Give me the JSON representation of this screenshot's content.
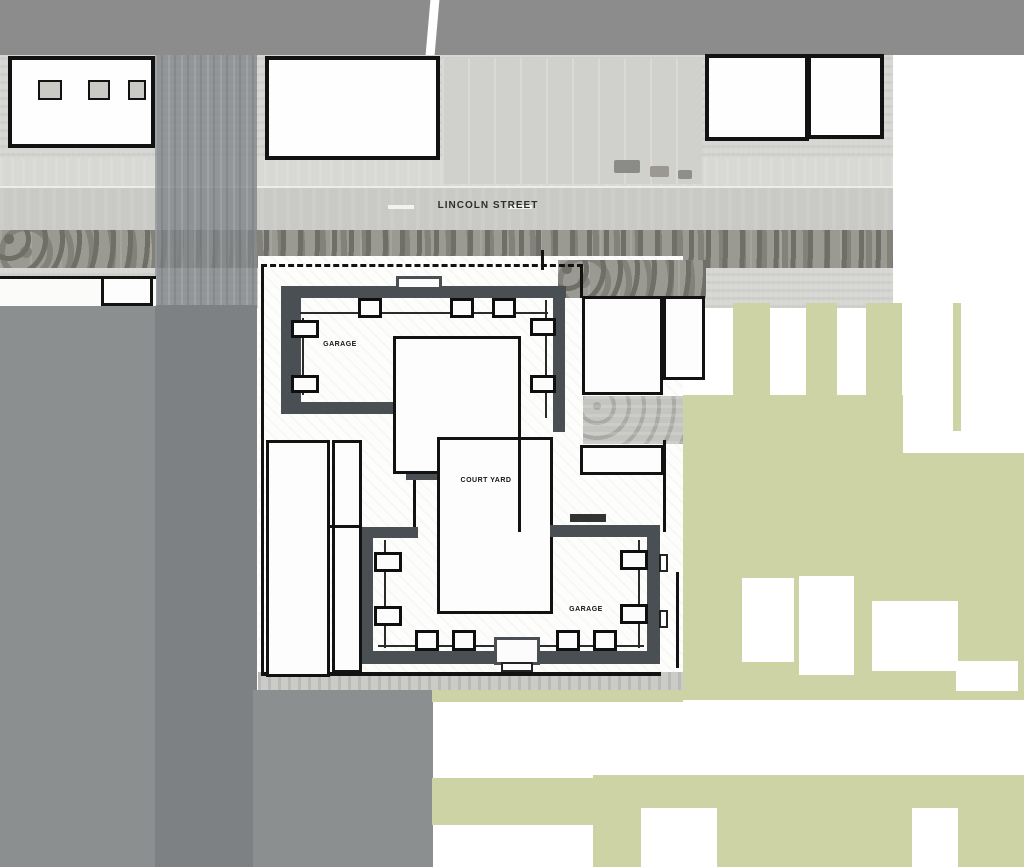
{
  "street": {
    "name_label": "LINCOLN STREET"
  },
  "plan": {
    "labels": {
      "upper_garage": "GARAGE",
      "courtyard": "COURT YARD",
      "lower_garage": "GARAGE"
    }
  },
  "colors": {
    "header_bar": "#8c8c8c",
    "road_gray": "#7d8184",
    "neutral_gray": "#8c8f8f",
    "green_space": "#cdd3a4",
    "plan_wall": "#4a4f53",
    "outline_black": "#121212",
    "aerial_light": "#d6d6d3"
  }
}
